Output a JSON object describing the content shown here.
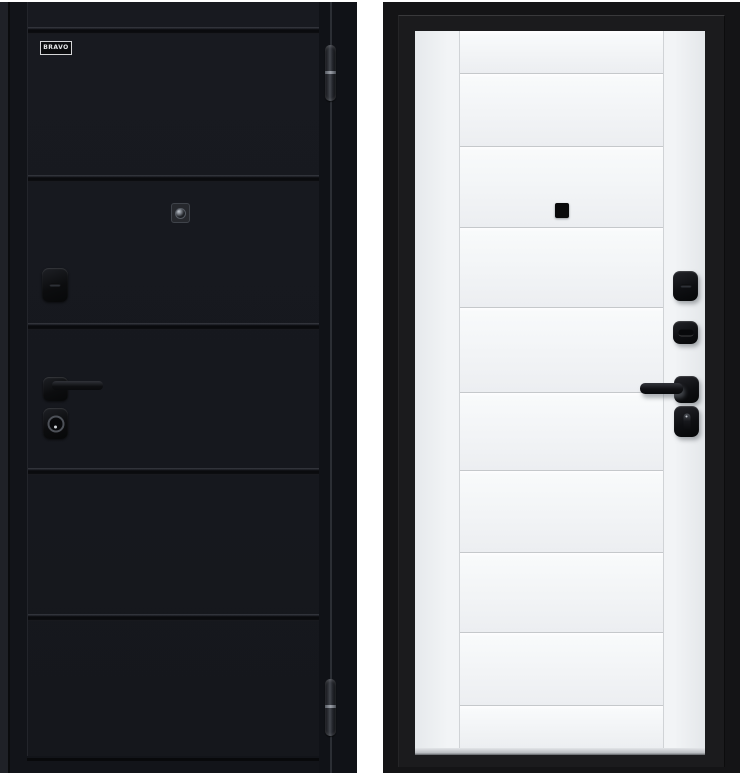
{
  "product_photo": {
    "subject": "steel entrance door, two sides",
    "background_color": "#ffffff"
  },
  "left_door": {
    "side": "exterior",
    "finish_color": "#17191f",
    "brand_label": "BRAVO",
    "panel_grooves": 5,
    "hinge_count": 2,
    "hardware": {
      "peephole": "round lens in square bezel",
      "latch_cover": "black rounded plate with slot",
      "handle": "black lever on square rosette",
      "cylinder": "black escutcheon with round keyway"
    }
  },
  "right_door": {
    "side": "interior",
    "frame_color": "#141416",
    "leaf_color": "#f1f3f5",
    "panel_lines": 9,
    "hardware": {
      "peephole": "black square",
      "lock_cover": "black rounded plate with slot",
      "thumbturn_upper": "black plate with horizontal turn",
      "handle": "black lever on square rosette",
      "thumbturn_lower": "black plate with vertical turn"
    }
  },
  "colors": {
    "bg": "#ffffff",
    "black-leaf": "#17191f",
    "frame-black": "#141416",
    "white-leaf": "#f1f3f5",
    "panel-line": "#c5c8cb",
    "hw-black": "#0c0d0f"
  }
}
